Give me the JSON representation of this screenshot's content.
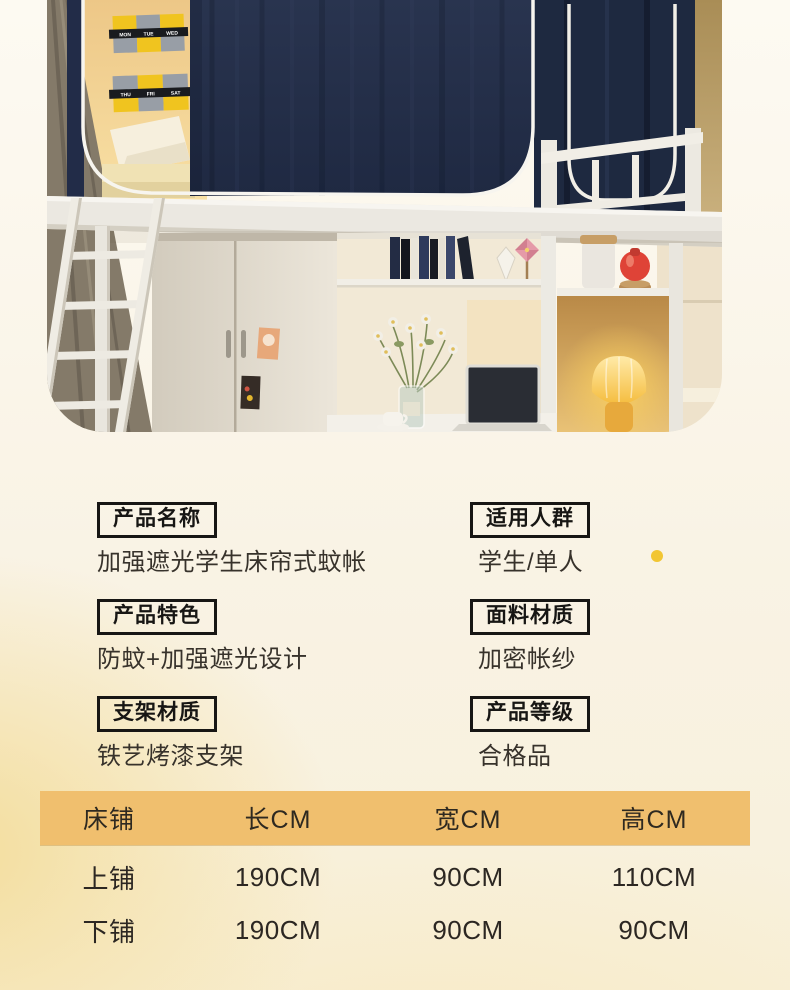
{
  "page": {
    "background_top": "#fdfaf2",
    "background_bottom": "#f6e9c2",
    "accent_dot_color": "#f2c633"
  },
  "photo": {
    "description": "dorm loft bed with navy blackout bed-curtain, ladder, wardrobe, desk and glowing lamp",
    "calendar_days": [
      "MON",
      "TUE",
      "WED",
      "THU",
      "FRI",
      "SAT"
    ],
    "colors": {
      "curtain_navy": "#232e4d",
      "wall_yellow": "#f3d08e",
      "frame_white": "#f1eee6",
      "lamp_glow": "#ffd45e"
    }
  },
  "specs": {
    "left": [
      {
        "label": "产品名称",
        "value": "加强遮光学生床帘式蚊帐"
      },
      {
        "label": "产品特色",
        "value": "防蚊+加强遮光设计"
      },
      {
        "label": "支架材质",
        "value": "铁艺烤漆支架"
      }
    ],
    "right": [
      {
        "label": "适用人群",
        "value": "学生/单人"
      },
      {
        "label": "面料材质",
        "value": "加密帐纱"
      },
      {
        "label": "产品等级",
        "value": "合格品"
      }
    ]
  },
  "size_table": {
    "header_bg": "#f0bf6e",
    "headers": [
      "床铺",
      "长CM",
      "宽CM",
      "高CM"
    ],
    "rows": [
      {
        "name": "上铺",
        "length": "190CM",
        "width": "90CM",
        "height": "110CM"
      },
      {
        "name": "下铺",
        "length": "190CM",
        "width": "90CM",
        "height": "90CM"
      }
    ]
  }
}
